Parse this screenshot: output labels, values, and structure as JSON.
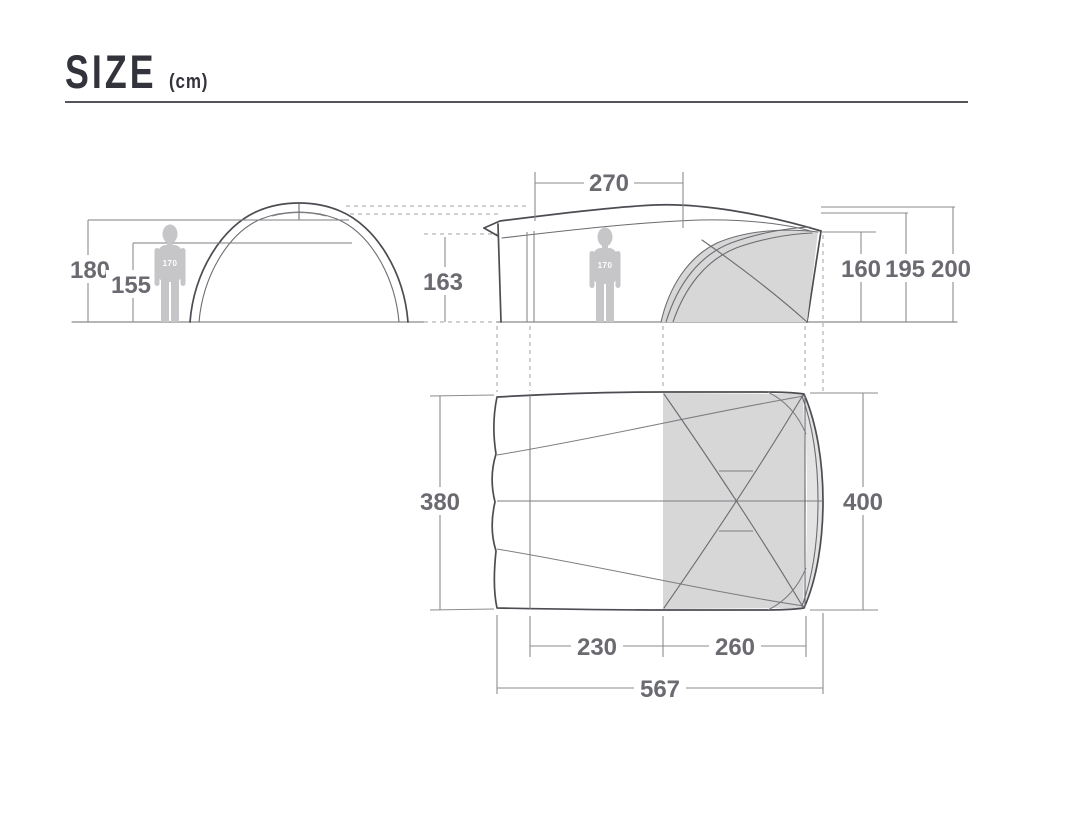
{
  "title": {
    "text": "SIZE",
    "unit": "(cm)"
  },
  "front_view": {
    "total_height": "180",
    "inner_height": "155",
    "person_height": "170"
  },
  "side_view": {
    "canopy_top_width": "270",
    "front_wall_height": "163",
    "inner_tent_height": "160",
    "ridge_height": "195",
    "peak_height": "200",
    "person_height": "170"
  },
  "floor_plan": {
    "canopy_width": "380",
    "inner_width": "400",
    "canopy_depth": "230",
    "inner_depth": "260",
    "total_depth": "567"
  },
  "colors": {
    "background": "#ffffff",
    "outline": "#4c4c52",
    "dimension_text": "#6a6a70",
    "inner_tent_fill": "#d7d7d8",
    "person_fill": "#c6c6c8",
    "title_text": "#33333b"
  }
}
